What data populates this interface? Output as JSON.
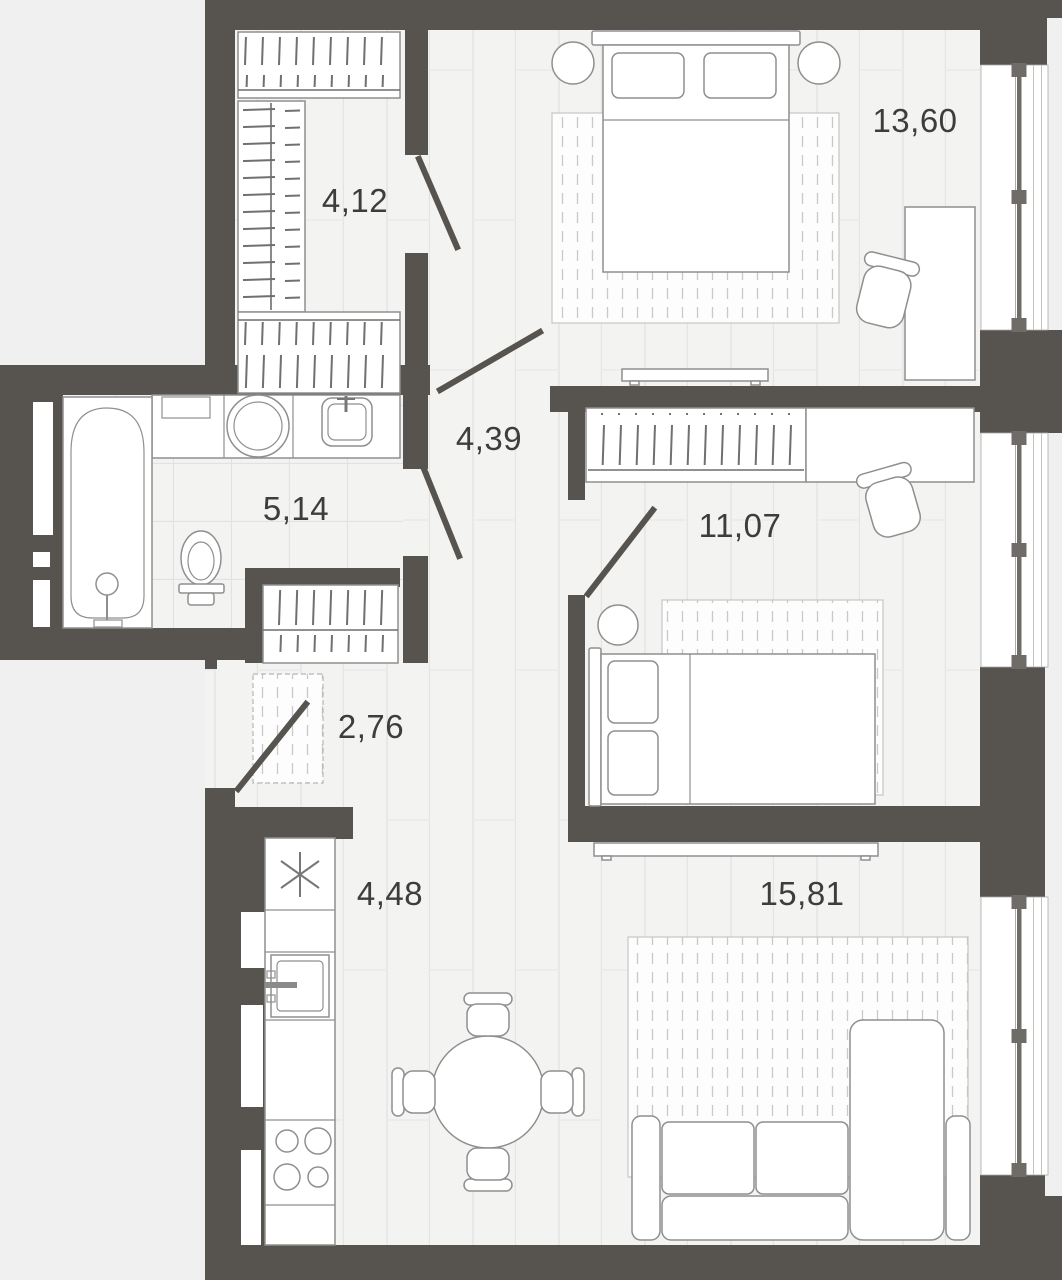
{
  "plan": {
    "type": "apartment-floor-plan",
    "rooms": [
      {
        "id": "walk-in-closet",
        "area_label": "4,12"
      },
      {
        "id": "bedroom-1",
        "area_label": "13,60"
      },
      {
        "id": "hallway",
        "area_label": "4,39"
      },
      {
        "id": "bathroom",
        "area_label": "5,14"
      },
      {
        "id": "bedroom-2",
        "area_label": "11,07"
      },
      {
        "id": "entry",
        "area_label": "2,76"
      },
      {
        "id": "kitchen",
        "area_label": "4,48"
      },
      {
        "id": "living-room",
        "area_label": "15,81"
      }
    ],
    "colors": {
      "wall": "#57544f",
      "floor": "#f3f3f2",
      "outside": "#eff0ef",
      "furniture_stroke": "#8f8f8f",
      "label_text": "#3d3d3d"
    }
  }
}
